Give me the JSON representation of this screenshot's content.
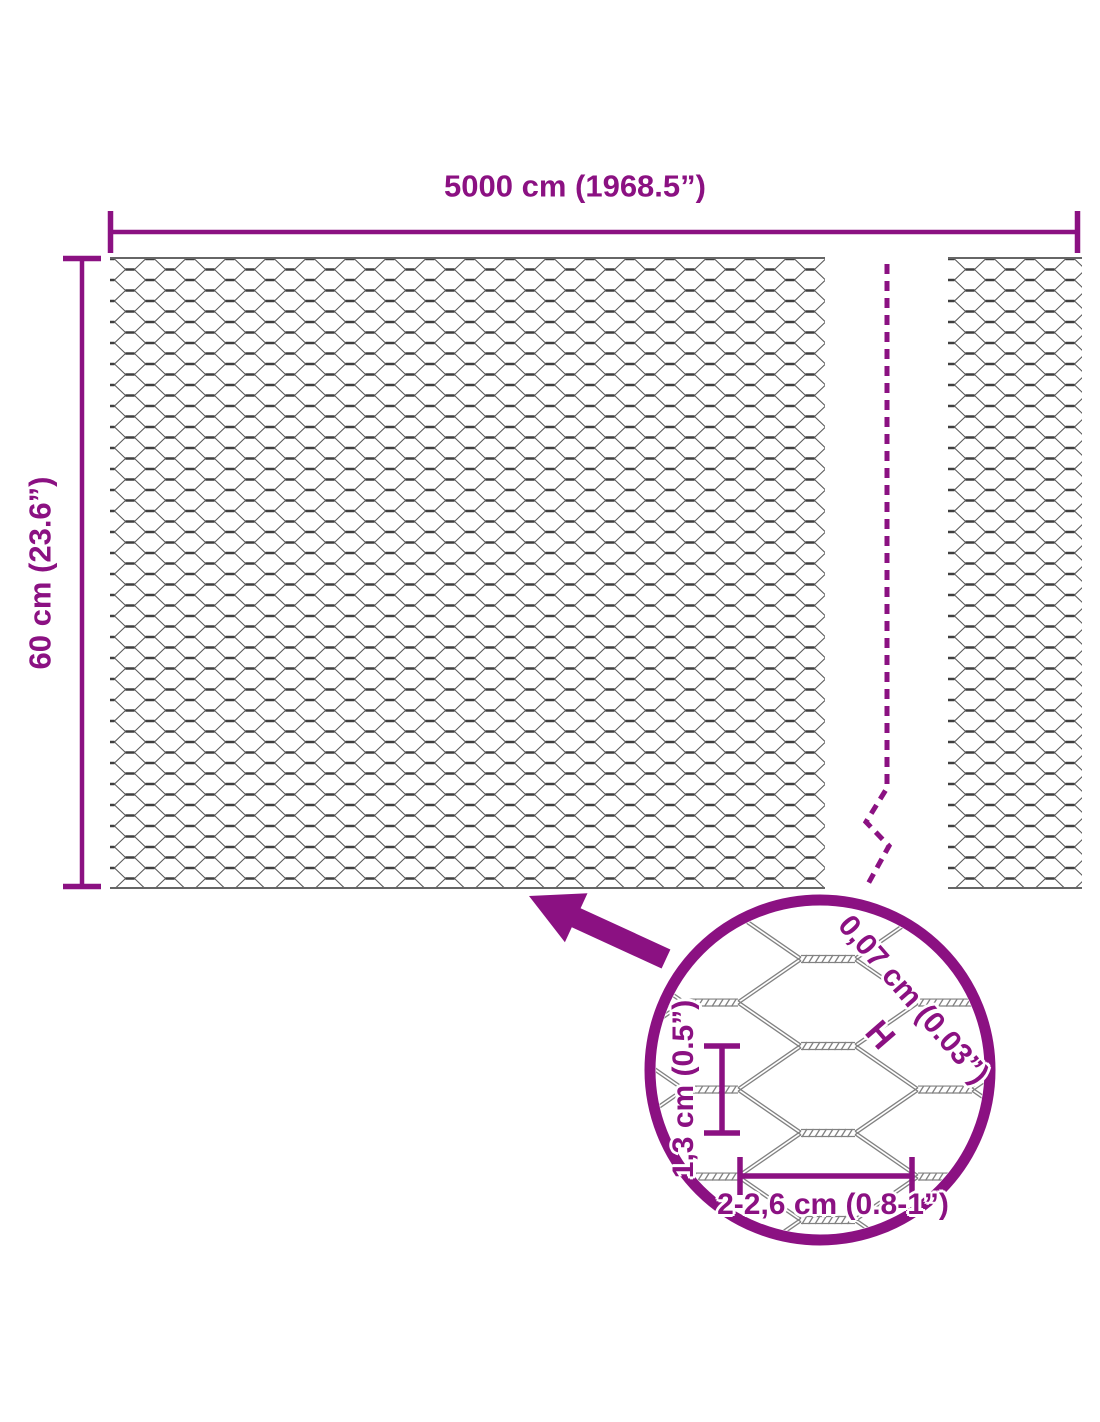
{
  "labels": {
    "total_width": "5000 cm (1968.5”)",
    "total_height": "60 cm (23.6”)",
    "wire_thickness": "0,07 cm (0.03”)",
    "wire_thickness_marker": "H",
    "mesh_height": "1,3 cm (0.5”)",
    "mesh_width": "2-2,6 cm (0.8-1”)"
  },
  "colors": {
    "accent": "#8b1182",
    "mesh_dark": "#3f3f3f",
    "mesh_light": "#5a5a5a",
    "mesh_edge": "#666666",
    "detail_wire": "#828282",
    "background": "#ffffff"
  }
}
